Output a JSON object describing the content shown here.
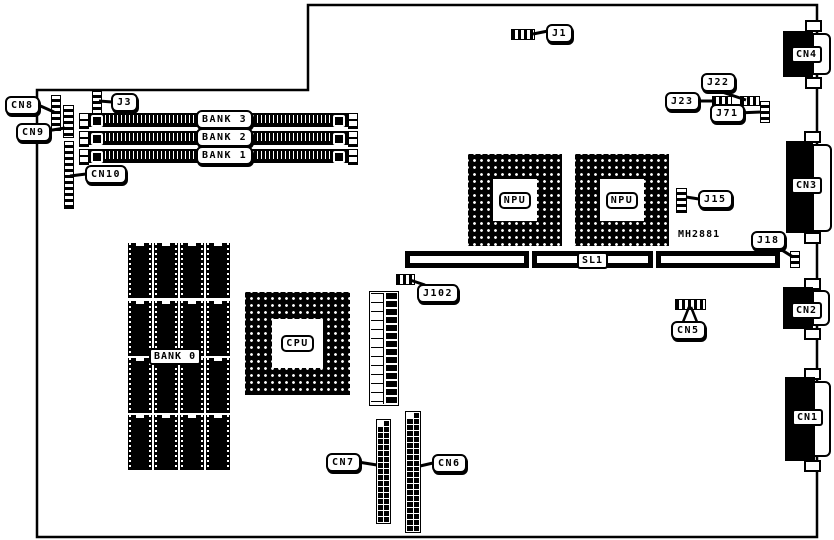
{
  "page": {
    "background": "#ffffff",
    "ink": "#000000"
  },
  "board": {
    "part_text": "MH2881",
    "chips": {
      "cpu_label": "CPU",
      "npu_label": "NPU"
    },
    "memory": {
      "bank0": "BANK 0",
      "bank1": "BANK 1",
      "bank2": "BANK 2",
      "bank3": "BANK 3"
    },
    "slots": {
      "sl1": "SL1"
    },
    "connectors": {
      "cn1": "CN1",
      "cn2": "CN2",
      "cn3": "CN3",
      "cn4": "CN4",
      "cn5": "CN5",
      "cn6": "CN6",
      "cn7": "CN7",
      "cn8": "CN8",
      "cn9": "CN9",
      "cn10": "CN10"
    },
    "jumpers": {
      "j1": "J1",
      "j3": "J3",
      "j15": "J15",
      "j18": "J18",
      "j22": "J22",
      "j23": "J23",
      "j71": "J71",
      "j102": "J102"
    }
  }
}
